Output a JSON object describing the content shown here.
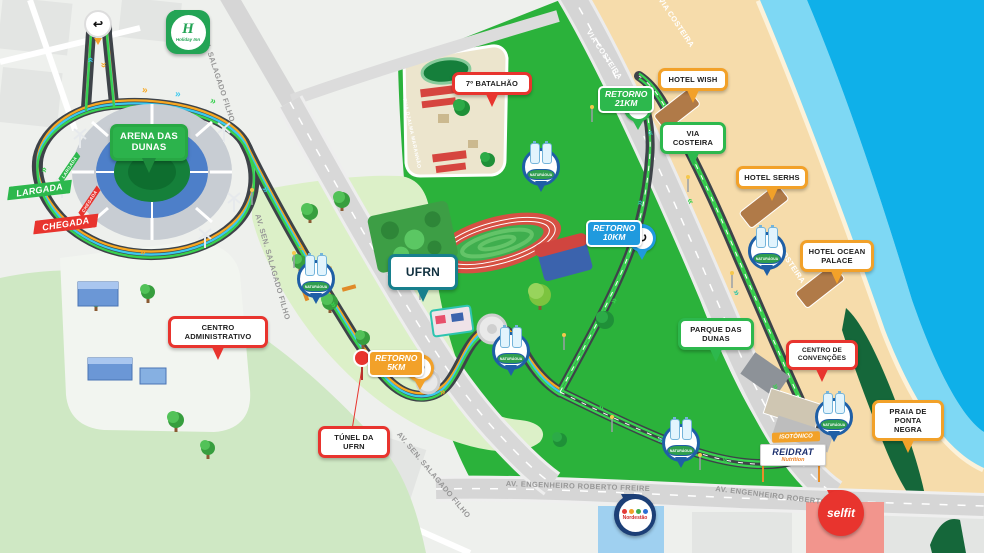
{
  "badges": {
    "arena": "ARENA DAS DUNAS",
    "centro_administrativo": "CENTRO ADMINISTRATIVO",
    "ufrn": "UFRN",
    "tunel_ufrn": "TÚNEL DA UFRN",
    "batalhao": "7º BATALHÃO",
    "hotel_wish": "HOTEL WISH",
    "via_costeira": "VIA COSTEIRA",
    "hotel_serhs": "HOTEL SERHS",
    "hotel_ocean_palace": "HOTEL OCEAN PALACE",
    "parque_das_dunas": "PARQUE DAS DUNAS",
    "centro_convencoes": "CENTRO DE CONVENÇÕES",
    "praia_ponta_negra": "PRAIA DE PONTA NEGRA"
  },
  "race": {
    "largada": "LARGADA",
    "chegada": "CHEGADA",
    "retorno21_l1": "RETORNO",
    "retorno21_l2": "21KM",
    "retorno10_l1": "RETORNO",
    "retorno10_l2": "10KM",
    "retorno5_l1": "RETORNO",
    "retorno5_l2": "5KM"
  },
  "streets": {
    "salgado_filho": "AV. SEN. SALAGADO FILHO",
    "roberto_freire": "AV. ENGENHEIRO ROBERTO FREIRE",
    "via_costeira": "VIA COSTEIRA",
    "djalma_maranhao": "RUA DJALMA MARANHÃO"
  },
  "sponsors": {
    "holiday_inn": "Holiday Inn",
    "holiday_inn_initial": "H",
    "selfit": "selfit",
    "nordestao": "Nordestão",
    "isotonico": "ISOTÔNICO",
    "reidrat": "REIDRAT",
    "reidrat_sub": "Nutrition",
    "naturagua": "NATURÁGUA"
  },
  "icons": {
    "chevron": "»",
    "uturn": "↩",
    "loop": "↻"
  },
  "colors": {
    "route_orange": "#f7a823",
    "route_cyan": "#3cc8ee",
    "route_green": "#39d14f",
    "route_teal": "#2ec4a9",
    "road_dark": "#3e4349",
    "park_green": "#2bb23b",
    "campus_green": "#dcf0c8",
    "sand": "#f6dcab",
    "shallow_water": "#7ed8f4",
    "ocean": "#0fb0e9",
    "dune_dark_green": "#15673a",
    "badge_red": "#e8342e",
    "badge_green": "#2db84d",
    "badge_orange": "#f2a129",
    "badge_teal": "#17808d",
    "retorno10_blue": "#1f9ade",
    "selfit_red": "#e8342e",
    "nordestao_navy": "#1c3f77",
    "holiday_green": "#23a455",
    "water_marker_blue": "#1f5fa6"
  }
}
